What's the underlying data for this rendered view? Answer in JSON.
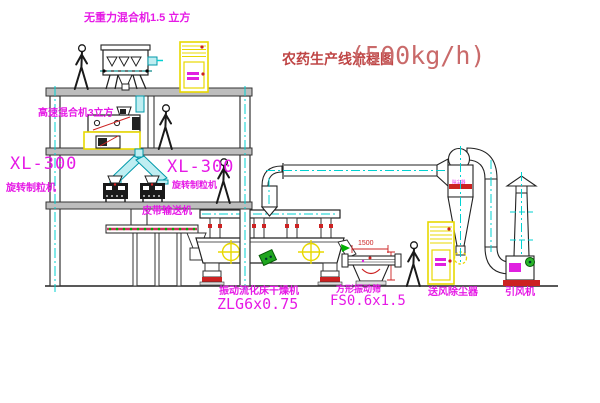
{
  "title": {
    "name_cn": "农药生产线流程图",
    "capacity": "(500kg/h)"
  },
  "equipment": {
    "gravity_mixer": {
      "label": "无重力混合机1.5 立方"
    },
    "high_speed_mixer": {
      "label": "高速混合机3立方"
    },
    "granulator_left": {
      "model": "XL-300",
      "name": "旋转制粒机"
    },
    "granulator_center": {
      "model": "XL-300",
      "name": "旋转制粒机"
    },
    "belt_conveyor": {
      "name": "皮带输送机"
    },
    "fluid_bed_dryer": {
      "name": "振动流化床干燥机",
      "model": "ZLG6x0.75"
    },
    "square_sieve": {
      "name": "方形振动筛",
      "model": "FS0.6x1.5",
      "length_dim": "1500"
    },
    "dust_collector": {
      "name": "送风除尘器",
      "tag": "除尘器"
    },
    "induced_fan": {
      "name": "引风机"
    }
  },
  "colors": {
    "label_magenta": "#e61ae6",
    "title_red": "#bf4545",
    "line_black": "#1c1c1c",
    "centerline_cyan": "#00d2d2",
    "equipment_yellow": "#e8d800",
    "detail_red": "#cc2222",
    "detail_green": "#00a500",
    "beam_gray": "#bdbdbd"
  }
}
